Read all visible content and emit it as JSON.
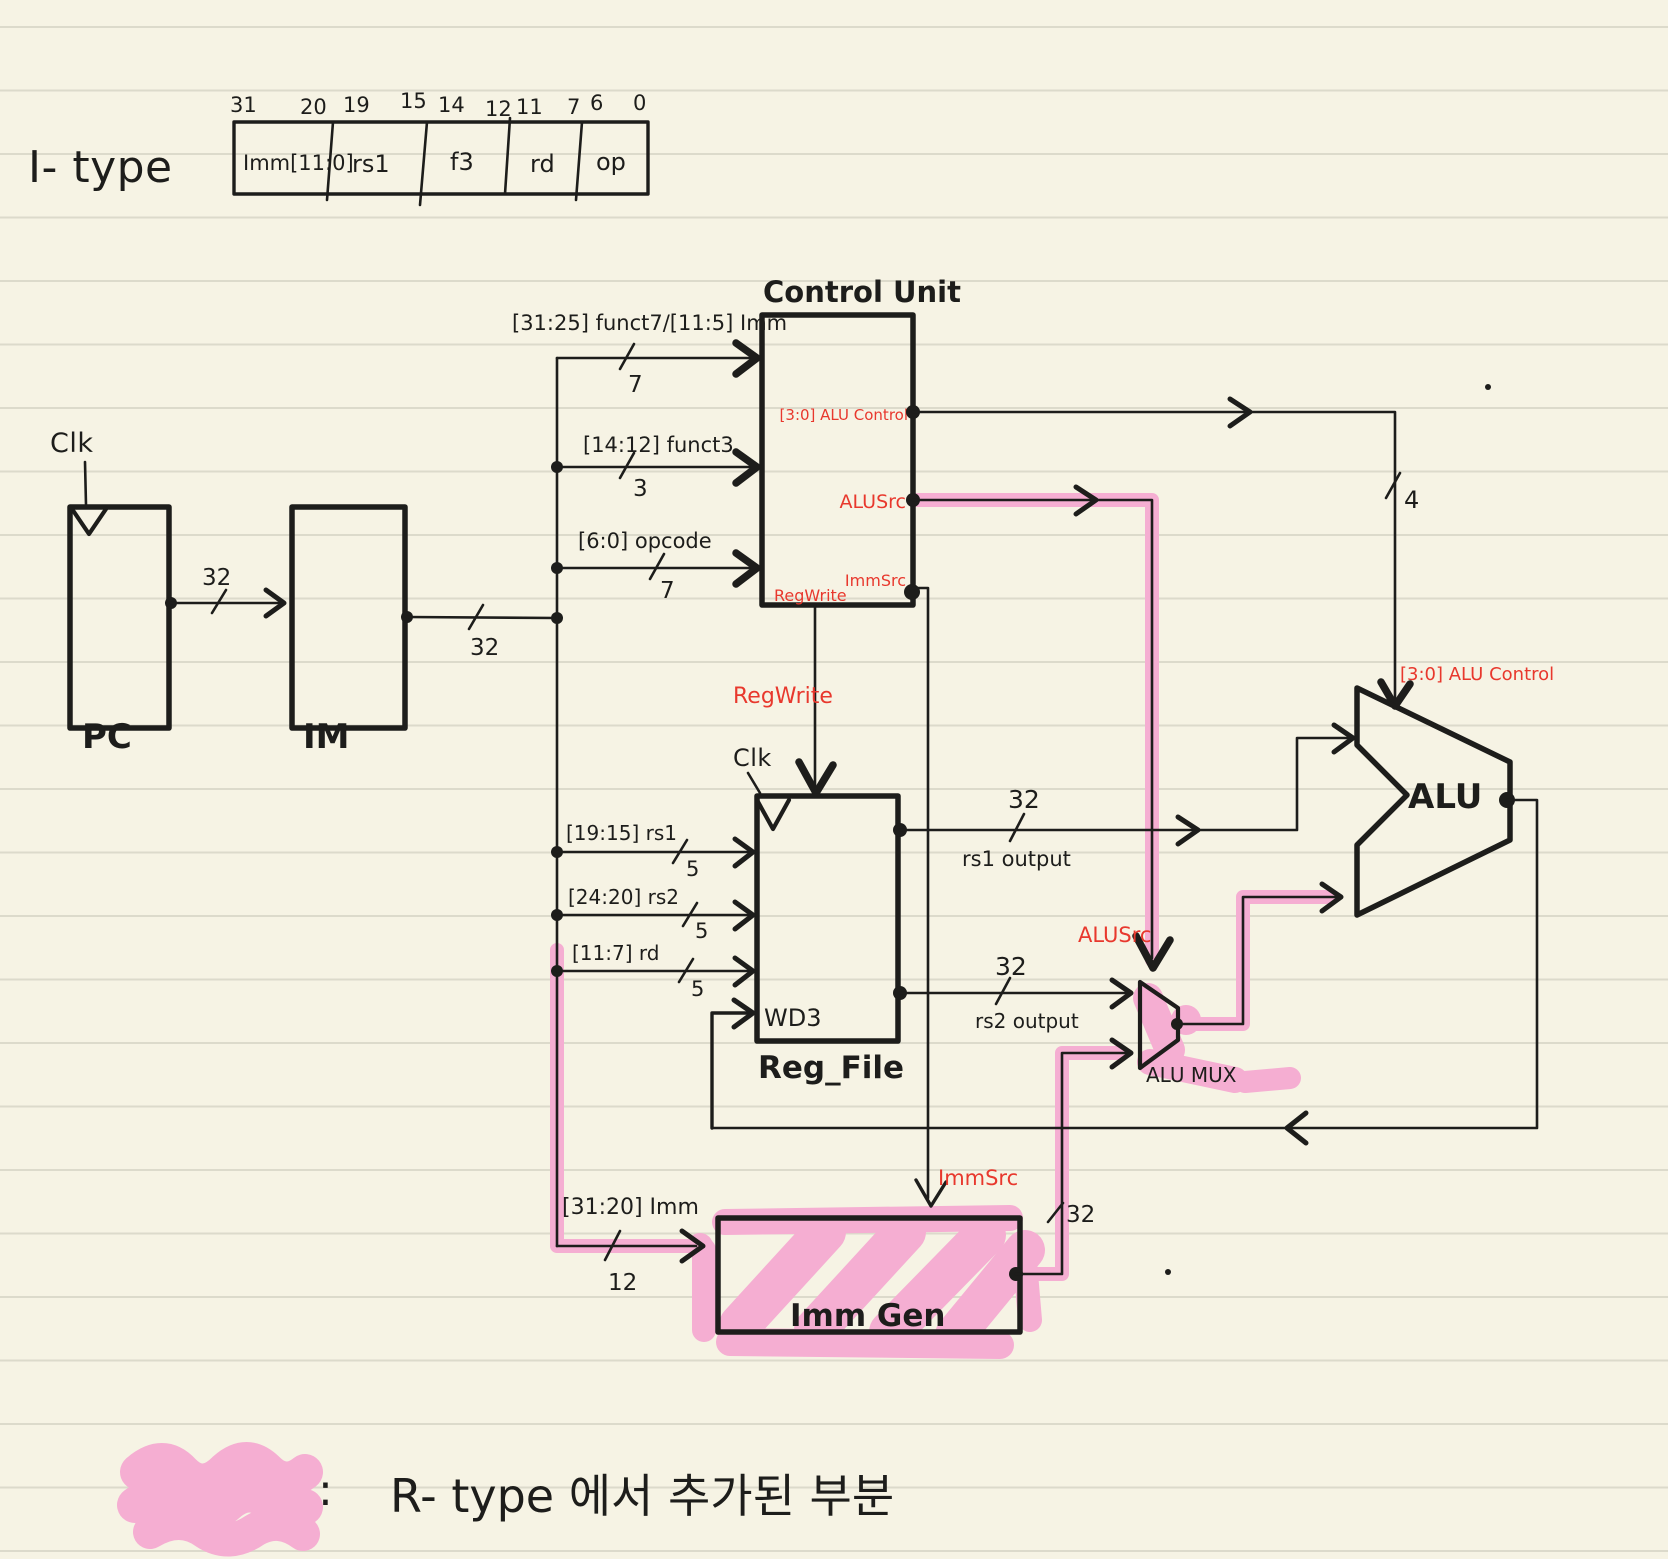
{
  "page": {
    "i_type_label": "I- type",
    "legend": {
      "colon": ":",
      "text": "R- type 에서  추가된   부분"
    }
  },
  "format_box": {
    "bit_labels": [
      "31",
      "20",
      "19",
      "15",
      "14",
      "12",
      "11",
      "7",
      "6",
      "0"
    ],
    "fields": [
      "Imm[11:0]",
      "rs1",
      "f3",
      "rd",
      "op"
    ]
  },
  "blocks": {
    "pc": "PC",
    "im": "IM",
    "control_unit": "Control Unit",
    "reg_file": "Reg_File",
    "wd3": "WD3",
    "imm_gen": "Imm Gen",
    "alu": "ALU",
    "alu_mux": "ALU MUX"
  },
  "signals": {
    "clk_pc": "Clk",
    "clk_rf": "Clk",
    "funct7": "[31:25] funct7/[11:5] Imm",
    "funct3": "[14:12] funct3",
    "opcode": "[6:0] opcode",
    "rs1": "[19:15] rs1",
    "rs2": "[24:20] rs2",
    "rd": "[11:7] rd",
    "imm": "[31:20] Imm",
    "alu_control_port": "[3:0] ALU Control",
    "alu_control_wire": "[3:0] ALU Control",
    "alusrc_port": "ALUSrc",
    "alusrc_wire": "ALUSrc",
    "immsrc_port": "ImmSrc",
    "immsrc_wire": "ImmSrc",
    "regwrite_port": "RegWrite",
    "regwrite_wire": "RegWrite",
    "rs1_output": "rs1 output",
    "rs2_output": "rs2 output"
  },
  "widths": {
    "w32": "32",
    "w7": "7",
    "w3": "3",
    "w5": "5",
    "w12": "12",
    "w4": "4"
  },
  "colors": {
    "ink": "#1d1d1b",
    "red": "#e8382d",
    "pink": "#f5aed2",
    "paper": "#f6f3e4"
  }
}
